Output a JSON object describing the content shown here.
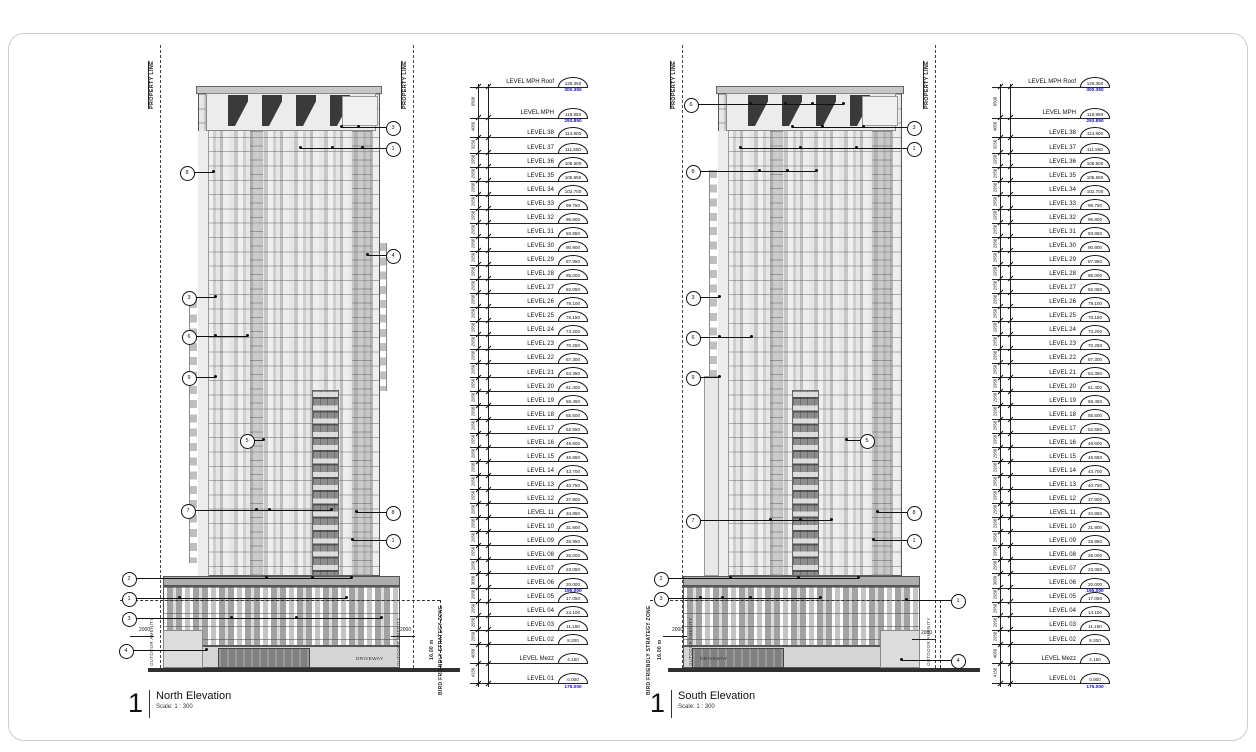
{
  "page": {
    "background": "#ffffff",
    "frame_border": "#c9ccd1",
    "datum_text_color": "#1111cc",
    "line_color": "#111111"
  },
  "levels": [
    {
      "name": "LEVEL MPH Roof",
      "value": "125.350",
      "datum": "300.350",
      "dim_below": "6500"
    },
    {
      "name": "LEVEL MPH",
      "value": "118.850",
      "datum": "293.850",
      "dim_below": "4050"
    },
    {
      "name": "LEVEL 38",
      "value": "114.800",
      "dim_below": "3250"
    },
    {
      "name": "LEVEL 37",
      "value": "111.550",
      "dim_below": "2950"
    },
    {
      "name": "LEVEL 36",
      "value": "108.600",
      "dim_below": "2950"
    },
    {
      "name": "LEVEL 35",
      "value": "105.650",
      "dim_below": "2950"
    },
    {
      "name": "LEVEL 34",
      "value": "102.700",
      "dim_below": "2950"
    },
    {
      "name": "LEVEL 33",
      "value": "99.750",
      "dim_below": "2950"
    },
    {
      "name": "LEVEL 32",
      "value": "96.800",
      "dim_below": "2950"
    },
    {
      "name": "LEVEL 31",
      "value": "93.850",
      "dim_below": "2950"
    },
    {
      "name": "LEVEL 30",
      "value": "90.900",
      "dim_below": "2950"
    },
    {
      "name": "LEVEL 29",
      "value": "87.950",
      "dim_below": "2950"
    },
    {
      "name": "LEVEL 28",
      "value": "85.000",
      "dim_below": "2950"
    },
    {
      "name": "LEVEL 27",
      "value": "82.050",
      "dim_below": "2950"
    },
    {
      "name": "LEVEL 26",
      "value": "79.100",
      "dim_below": "2950"
    },
    {
      "name": "LEVEL 25",
      "value": "76.150",
      "dim_below": "2950"
    },
    {
      "name": "LEVEL 24",
      "value": "73.200",
      "dim_below": "2950"
    },
    {
      "name": "LEVEL 23",
      "value": "70.250",
      "dim_below": "2950"
    },
    {
      "name": "LEVEL 22",
      "value": "67.300",
      "dim_below": "2950"
    },
    {
      "name": "LEVEL 21",
      "value": "64.350",
      "dim_below": "2950"
    },
    {
      "name": "LEVEL 20",
      "value": "61.400",
      "dim_below": "2950"
    },
    {
      "name": "LEVEL 19",
      "value": "58.450",
      "dim_below": "2950"
    },
    {
      "name": "LEVEL 18",
      "value": "55.500",
      "dim_below": "2950"
    },
    {
      "name": "LEVEL 17",
      "value": "52.550",
      "dim_below": "2950"
    },
    {
      "name": "LEVEL 16",
      "value": "49.600",
      "dim_below": "2950"
    },
    {
      "name": "LEVEL 15",
      "value": "46.650",
      "dim_below": "2950"
    },
    {
      "name": "LEVEL 14",
      "value": "43.700",
      "dim_below": "2950"
    },
    {
      "name": "LEVEL 13",
      "value": "40.750",
      "dim_below": "2950"
    },
    {
      "name": "LEVEL 12",
      "value": "37.800",
      "dim_below": "2950"
    },
    {
      "name": "LEVEL 11",
      "value": "34.850",
      "dim_below": "2950"
    },
    {
      "name": "LEVEL 10",
      "value": "31.900",
      "dim_below": "2950"
    },
    {
      "name": "LEVEL 09",
      "value": "28.950",
      "dim_below": "2950"
    },
    {
      "name": "LEVEL 08",
      "value": "26.000",
      "dim_below": "2950"
    },
    {
      "name": "LEVEL 07",
      "value": "23.050",
      "dim_below": "3050"
    },
    {
      "name": "LEVEL 06",
      "value": "20.000",
      "datum": "195.000",
      "dim_below": "2950"
    },
    {
      "name": "LEVEL 05",
      "value": "17.050",
      "dim_below": "2950"
    },
    {
      "name": "LEVEL 04",
      "value": "14.100",
      "dim_below": "2950"
    },
    {
      "name": "LEVEL 03",
      "value": "11.150",
      "dim_below": "2950"
    },
    {
      "name": "LEVEL 02",
      "value": "8.200",
      "dim_below": "4050"
    },
    {
      "name": "LEVEL Mezz",
      "value": "4.150",
      "dim_below": "4150"
    },
    {
      "name": "LEVEL 01",
      "value": "0.000",
      "datum": "175.000"
    }
  ],
  "sheets": [
    {
      "id": "north",
      "number": "1",
      "title": "North Elevation",
      "scale": "Scale:  1 : 300",
      "property_line": "PROPERTY LINE",
      "bird_zone": "BIRD FRIENDLY STRATEGY ZONE",
      "bird_height": "16.00 m",
      "outdoor_amenity": "OUTDOOR AMENITY",
      "driveway": "DRIVEWAY",
      "setback_dim": "2000",
      "keynotes": [
        {
          "n": "3",
          "x": 392,
          "y": 127,
          "to": 341,
          "dots": [
            341,
            358
          ]
        },
        {
          "n": "1",
          "x": 392,
          "y": 148,
          "to": 300,
          "dots": [
            300,
            332,
            362
          ]
        },
        {
          "n": "8",
          "x": 186,
          "y": 172,
          "to": 213,
          "dots": [
            213
          ]
        },
        {
          "n": "4",
          "x": 392,
          "y": 255,
          "to": 367,
          "dots": [
            367
          ]
        },
        {
          "n": "3",
          "x": 188,
          "y": 297,
          "to": 215,
          "dots": [
            215
          ]
        },
        {
          "n": "6",
          "x": 188,
          "y": 336,
          "to": 247,
          "dots": [
            215,
            247
          ]
        },
        {
          "n": "9",
          "x": 188,
          "y": 377,
          "to": 215,
          "dots": [
            215
          ]
        },
        {
          "n": "5",
          "x": 246,
          "y": 440,
          "to": 263,
          "dots": [
            263
          ]
        },
        {
          "n": "7",
          "x": 187,
          "y": 510,
          "to": 331,
          "dots": [
            256,
            269,
            331
          ]
        },
        {
          "n": "8",
          "x": 392,
          "y": 512,
          "to": 356,
          "dots": [
            356
          ]
        },
        {
          "n": "1",
          "x": 392,
          "y": 540,
          "to": 352,
          "dots": [
            352
          ]
        },
        {
          "n": "2",
          "x": 128,
          "y": 578,
          "to": 351,
          "dots": [
            266,
            312,
            351
          ]
        },
        {
          "n": "1",
          "x": 128,
          "y": 598,
          "to": 346,
          "dots": [
            179,
            346
          ]
        },
        {
          "n": "3",
          "x": 128,
          "y": 618,
          "to": 381,
          "dots": [
            231,
            296,
            381
          ]
        },
        {
          "n": "4",
          "x": 125,
          "y": 650,
          "to": 206,
          "dots": [
            206
          ]
        }
      ]
    },
    {
      "id": "south",
      "number": "1",
      "title": "South Elevation",
      "scale": "Scale:  1 : 300",
      "property_line": "PROPERTY LINE",
      "bird_zone": "BIRD FRIENDLY STRATEGY ZONE",
      "bird_height": "16.00 m",
      "outdoor_amenity": "OUTDOOR AMENITY",
      "driveway": "DRIVEWAY",
      "setback_dim": "2000",
      "keynotes": [
        {
          "n": "6",
          "x": 690,
          "y": 104,
          "to": 843,
          "dots": [
            750,
            785,
            812,
            843
          ]
        },
        {
          "n": "3",
          "x": 913,
          "y": 127,
          "to": 792,
          "dots": [
            792,
            822,
            863
          ]
        },
        {
          "n": "1",
          "x": 913,
          "y": 148,
          "to": 740,
          "dots": [
            740,
            800,
            856
          ]
        },
        {
          "n": "8",
          "x": 692,
          "y": 171,
          "to": 816,
          "dots": [
            759,
            787,
            816
          ]
        },
        {
          "n": "3",
          "x": 692,
          "y": 297,
          "to": 719,
          "dots": [
            719
          ]
        },
        {
          "n": "6",
          "x": 692,
          "y": 337,
          "to": 751,
          "dots": [
            719,
            751
          ]
        },
        {
          "n": "9",
          "x": 692,
          "y": 377,
          "to": 719,
          "dots": [
            719
          ]
        },
        {
          "n": "5",
          "x": 866,
          "y": 440,
          "to": 846,
          "dots": [
            846
          ]
        },
        {
          "n": "7",
          "x": 692,
          "y": 520,
          "to": 831,
          "dots": [
            770,
            800,
            831
          ]
        },
        {
          "n": "8",
          "x": 913,
          "y": 512,
          "to": 877,
          "dots": [
            877
          ]
        },
        {
          "n": "1",
          "x": 913,
          "y": 540,
          "to": 873,
          "dots": [
            873
          ]
        },
        {
          "n": "2",
          "x": 660,
          "y": 578,
          "to": 858,
          "dots": [
            730,
            798,
            858
          ]
        },
        {
          "n": "3",
          "x": 660,
          "y": 598,
          "to": 820,
          "dots": [
            700,
            722,
            750,
            820
          ]
        },
        {
          "n": "1",
          "x": 957,
          "y": 600,
          "to": 906,
          "dots": [
            906
          ]
        },
        {
          "n": "4",
          "x": 957,
          "y": 660,
          "to": 901,
          "dots": [
            901
          ]
        }
      ]
    }
  ]
}
